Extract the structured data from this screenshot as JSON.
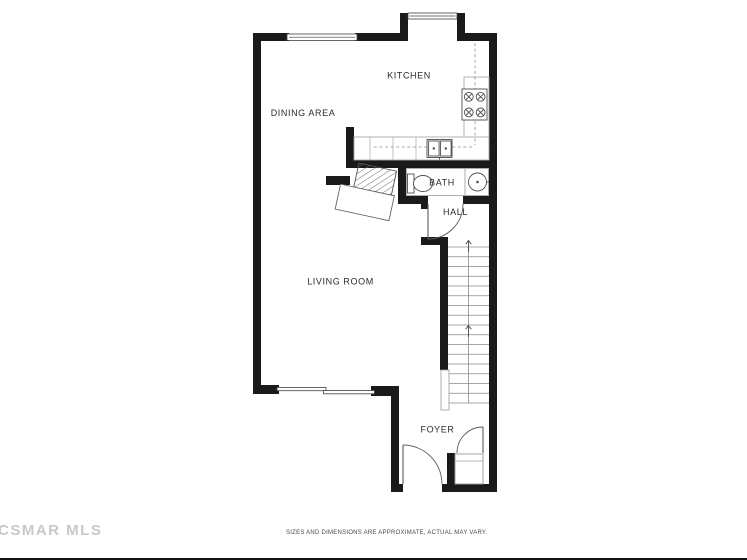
{
  "floor_plan": {
    "title": "Townhouse first-floor plan",
    "rooms": {
      "kitchen": "KITCHEN",
      "dining": "DINING AREA",
      "bath": "BATH",
      "hall": "HALL",
      "living": "LIVING ROOM",
      "foyer": "FOYER"
    },
    "fixtures": [
      "stove-4-burner",
      "kitchen-double-sink",
      "upper-cabinets-dashed",
      "toilet",
      "bath-round-sink",
      "corner-fireplace-with-hearth",
      "staircase-up",
      "foyer-closet",
      "sliding-glass-door",
      "entry-door",
      "hall-door",
      "closet-door",
      "window-dining",
      "window-kitchen"
    ],
    "watermark": "CSMAR MLS",
    "disclaimer": "SIZES AND DIMENSIONS ARE APPROXIMATE, ACTUAL MAY VARY.",
    "colors": {
      "wall": "#1a1a1a",
      "fixture_line": "#4d4d4d",
      "counter_line": "#a9a9a9",
      "stair_line": "#8a8a8a",
      "label_text": "#2b2b2b",
      "watermark": "#c8c8c8",
      "disclaimer": "#4a4a4a",
      "background": "#ffffff"
    }
  }
}
